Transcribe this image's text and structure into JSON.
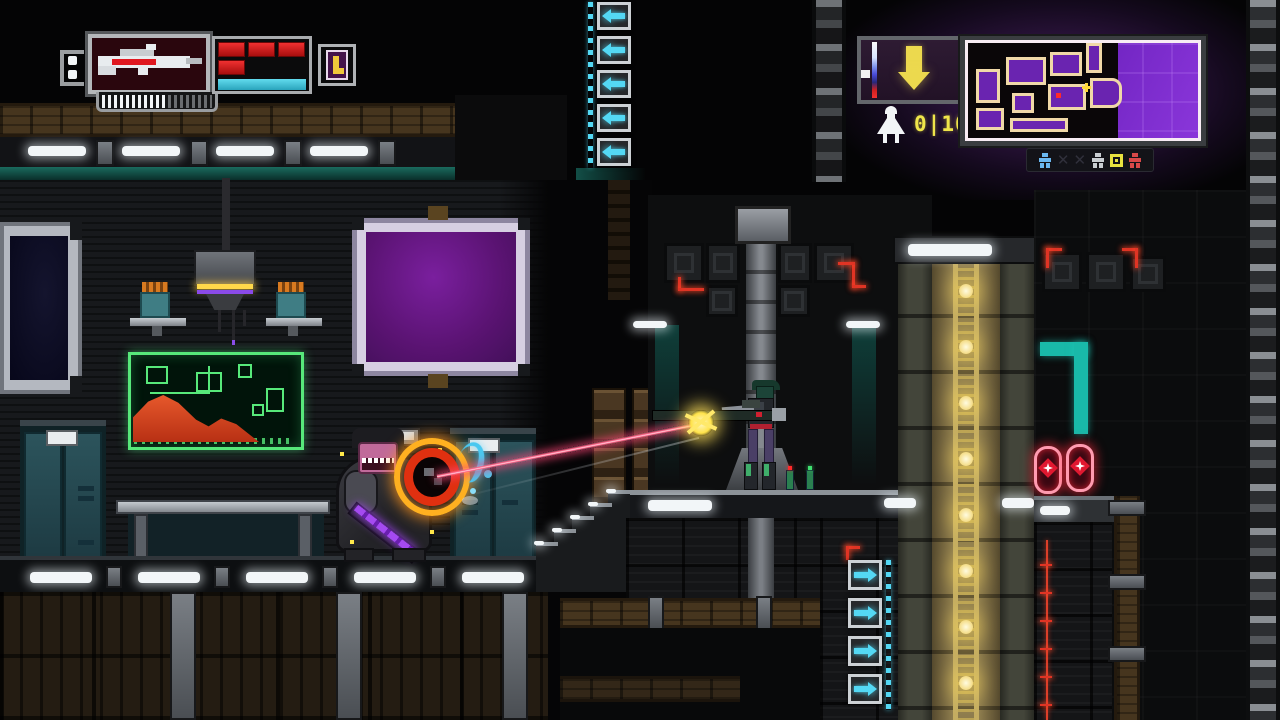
{
  "hud_left": {
    "weapon_slot_icon": "rifle-sprite",
    "ammo_ticks_total": 18,
    "ammo_ticks_bright": 11,
    "health_blocks_filled": 4,
    "health_block_color": "#e01818",
    "energy_bar_color": "#3cc6de",
    "boot_badge_icon": "boot-icon",
    "boot_badge_bg": "#45134a"
  },
  "hud_right": {
    "drop_indicator_icon": "down-arrow-icon",
    "drop_indicator_color": "#ecd94e",
    "gauge_icon": "vertical-gauge",
    "ship_icon": "ship-icon",
    "objective": {
      "current": "0",
      "separator": "|",
      "max": "10"
    },
    "minimap": {
      "bg_color": "#7326c4",
      "border_color": "#f8ecf4",
      "room_outline_color": "#f0d8a8",
      "player_marker_color": "#ff2a2a",
      "objective_marker_color": "#ffd83a",
      "legend_icons": [
        "ally-figure",
        "cross-mark",
        "cross-mark",
        "neutral-figure",
        "objective-target",
        "enemy-figure"
      ]
    }
  },
  "scene": {
    "laser_color": "#ff5f86",
    "muzzle_flash_color": "#ffe84a",
    "impact_ring_colors": [
      "#ffb020",
      "#e03010"
    ],
    "pickup_items": 2,
    "elevator_light_color": "#ffe9a0",
    "map_screen_accent": "#57e87a",
    "map_screen_chart_color": "#e85428"
  }
}
